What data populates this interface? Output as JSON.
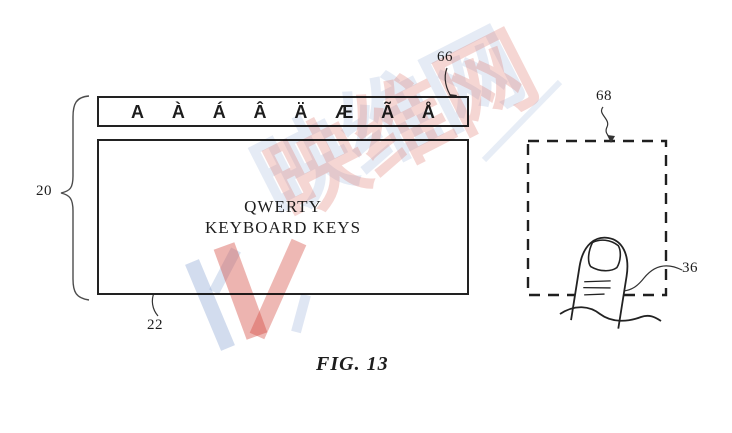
{
  "figure": {
    "caption": "FIG. 13",
    "ref_labels": {
      "accent_bar": "66",
      "keyboard_group": "20",
      "keyboard_box": "22",
      "touch_area": "68",
      "finger": "36"
    }
  },
  "keyboard": {
    "accent_row": {
      "keys": [
        "A",
        "À",
        "Á",
        "Â",
        "Ä",
        "Æ",
        "Ã",
        "Å"
      ]
    },
    "main_area": {
      "line1": "QWERTY",
      "line2": "KEYBOARD KEYS"
    }
  },
  "watermark": {
    "text": "映维网",
    "logo": "yv-logo",
    "pink": "#de766c",
    "blue": "#94acd6"
  },
  "colors": {
    "line": "#222222",
    "background": "#ffffff"
  }
}
